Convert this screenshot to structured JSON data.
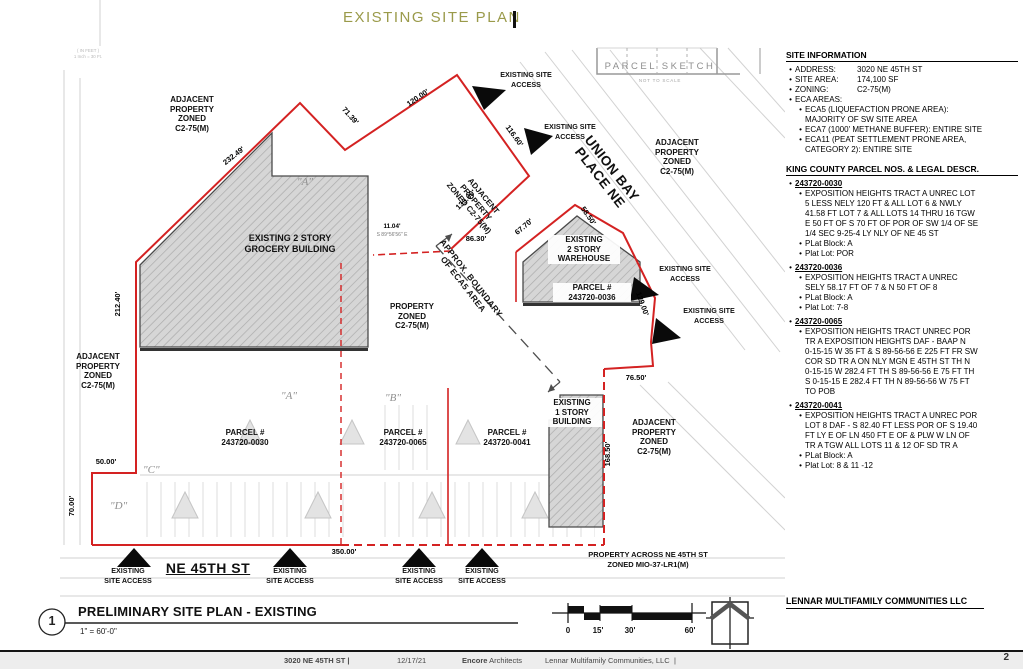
{
  "header": {
    "title": "EXISTING SITE PLAN"
  },
  "plan": {
    "labels": {
      "adjacent_property": "ADJACENT\nPROPERTY\nZONED\nC2-75(M)",
      "adjacent_property_rotated": "ADJACENT\nPROPERTY\nZONED C2-75(M)",
      "grocery_building": "EXISTING 2 STORY\nGROCERY BUILDING",
      "warehouse_building": "EXISTING\n2 STORY\nWAREHOUSE",
      "warehouse_parcel": "PARCEL #\n243720-0036",
      "one_story_building": "EXISTING\n1 STORY\nBUILDING",
      "parcel_0030": "PARCEL #\n243720-0030",
      "parcel_0065": "PARCEL #\n243720-0065",
      "parcel_0041": "PARCEL #\n243720-0041",
      "property_zoned": "PROPERTY\nZONED\nC2-75(M)",
      "eca_boundary": "APPROX. BOUNDARY\nOF ECA5 AREA",
      "street_union_bay": "UNION BAY\nPLACE NE",
      "parcel_sketch": "PARCEL SKETCH",
      "not_to_scale": "NOT TO SCALE",
      "street_ne45": "NE 45TH ST",
      "property_across": "PROPERTY ACROSS NE 45TH ST\nZONED MIO-37-LR1(M)",
      "site_access": "EXISTING SITE\nACCESS",
      "site_access_alt": "EXISTING\nSITE ACCESS",
      "survey_scale_note": "( IN FEET )\n1 Inch = 30 Ft.",
      "area_a_upper": "\"A\"",
      "area_a": "\"A\"",
      "area_b": "\"B\"",
      "area_c": "\"C\"",
      "area_d": "\"D\""
    },
    "dimensions": {
      "nw_diagonal": "232.49'",
      "notch": "71.39'",
      "top_edge": "120.00'",
      "access_edge": "116.60'",
      "inner_diagonal": "133.00'",
      "inner_horizontal": "86.30'",
      "jog": "11.04'",
      "jog_bearing": "S 89°56'56\" E",
      "warehouse_sw": "67.70'",
      "warehouse_ne": "58.50'",
      "union_bay_edge": "129.00'",
      "east_notch": "76.50'",
      "east_side": "168.50'",
      "west_side": "212.40'",
      "west_step": "50.00'",
      "west_lower": "70.00'",
      "south_edge": "350.00'"
    },
    "colors": {
      "boundary_red": "#d42222",
      "title_olive": "#9a9a4a"
    }
  },
  "titleblock": {
    "number": "1",
    "title": "PRELIMINARY SITE PLAN - EXISTING",
    "scale": "1\" = 60'-0\""
  },
  "scalebar": {
    "t0": "0",
    "t15": "15'",
    "t30": "30'",
    "t60": "60'"
  },
  "sidebar": {
    "site_info": {
      "heading": "SITE INFORMATION",
      "rows": [
        {
          "label": "ADDRESS:",
          "value": "3020 NE 45TH ST"
        },
        {
          "label": "SITE AREA:",
          "value": "174,100 SF"
        },
        {
          "label": "ZONING:",
          "value": "C2-75(M)"
        }
      ],
      "eca_label": "ECA AREAS:",
      "eca_items": [
        "ECA5 (LIQUEFACTION PRONE AREA):\nMAJORITY OF SW SITE AREA",
        "ECA7 (1000' METHANE BUFFER): ENTIRE SITE",
        "ECA11 (PEAT SETTLEMENT PRONE AREA,\nCATEGORY 2):  ENTIRE SITE"
      ]
    },
    "parcels": {
      "heading": "KING COUNTY PARCEL NOS. & LEGAL DESCR.",
      "entries": [
        {
          "id": "243720-0030",
          "legal": "EXPOSITION HEIGHTS TRACT A UNREC LOT\n5 LESS NELY 120 FT & ALL LOT 6 & NWLY\n41.58 FT LOT 7 & ALL LOTS 14 THRU 16 TGW\nE 50 FT OF S 70 FT OF POR OF SW 1/4 OF SE\n1/4 SEC 9-25-4 LY NLY OF NE 45 ST",
          "plat_block": "PLat Block: A",
          "plat_lot": "Plat Lot: POR"
        },
        {
          "id": "243720-0036",
          "legal": "EXPOSITION HEIGHTS TRACT A UNREC\nSELY 58.17 FT OF 7 & N 50 FT OF 8",
          "plat_block": "PLat Block: A",
          "plat_lot": "Plat Lot: 7-8"
        },
        {
          "id": "243720-0065",
          "legal": "EXPOSITION HEIGHTS TRACT UNREC POR\nTR A EXPOSITION HEIGHTS DAF - BAAP N\n0-15-15 W 35 FT & S 89-56-56 E 225 FT FR SW\nCOR SD TR A ON NLY MGN E 45TH ST TH N\n0-15-15 W 282.4 FT TH S 89-56-56 E 75 FT TH\nS 0-15-15 E 282.4 FT TH N 89-56-56 W 75 FT\nTO POB"
        },
        {
          "id": "243720-0041",
          "legal": "EXPOSITION HEIGHTS TRACT A UNREC POR\nLOT 8 DAF - S 82.40 FT LESS POR OF S 19.40\nFT LY E OF LN 450 FT E OF & PLW W LN OF\nTR A TGW ALL LOTS 11 & 12 OF SD TR A",
          "plat_block": "PLat Block: A",
          "plat_lot": "Plat Lot: 8 & 11 -12"
        }
      ]
    },
    "owner": "LENNAR MULTIFAMILY COMMUNITIES LLC"
  },
  "footer": {
    "address": "3020 NE 45TH ST |",
    "date": "12/17/21",
    "firm_bold": "Encore",
    "firm_rest": " Architects",
    "client": "Lennar Multifamily Communities, LLC",
    "separator": "|",
    "page_number": "2"
  }
}
